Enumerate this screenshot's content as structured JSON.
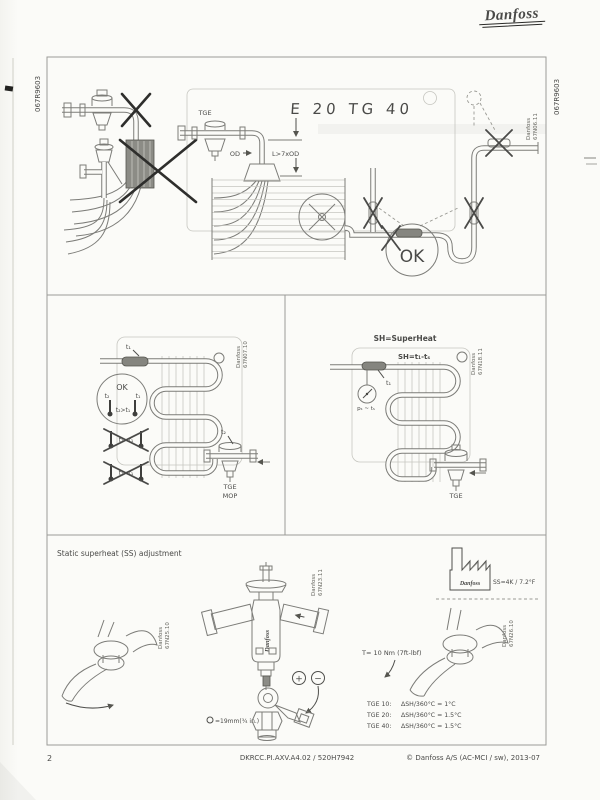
{
  "page": {
    "logo": "Danfoss",
    "code_left": "067R9603",
    "code_right": "067R9603",
    "footer": {
      "page": "2",
      "doc_id": "DKRCC.PI.AXV.A4.02 / 520H7942",
      "copyright": "© Danfoss A/S (AC-MCI / sw), 2013-07"
    },
    "colors": {
      "paper": "#fbfbf8",
      "line": "#7c7c78",
      "text": "#4a4a48"
    }
  },
  "panel_mounting": {
    "fig_brand": "Danfoss",
    "fig_no": "67N06.11",
    "valve_label": "TGE",
    "od_label": "OD",
    "length_label": "L>7xOD",
    "ok_label": "OK",
    "ghost_text": "E 20 TG 40"
  },
  "panel_bulb_check": {
    "fig_brand": "Danfoss",
    "fig_no": "67N07.10",
    "t1": "t₁",
    "t2": "t₂",
    "ok": "OK",
    "ok_t2": "t₂",
    "ok_t1": "t₁",
    "rule_ok": "t₂>t₁",
    "rule_wrong_equal": "t₂≈t₁",
    "rule_wrong_less": "t₂<t₁",
    "valve_line1": "TGE",
    "valve_line2": "MOP"
  },
  "panel_superheat": {
    "fig_brand": "Danfoss",
    "fig_no": "67N18.11",
    "title": "SH=SuperHeat",
    "formula": "SH=t₁-tₛ",
    "t1": "t₁",
    "gauge": "pₛ ~ tₛ",
    "valve_label": "TGE"
  },
  "panel_adjustment": {
    "title": "Static superheat (SS) adjustment",
    "factory_brand": "Danfoss",
    "factory_label": "SS=4K / 7.2°F",
    "fig_left_brand": "Danfoss",
    "fig_left_no": "67N25.10",
    "fig_center_brand": "Danfoss",
    "fig_center_no": "67N23.11",
    "fig_right_brand": "Danfoss",
    "fig_right_no": "67N26.10",
    "valve_brand": "Danfoss",
    "plus": "+",
    "minus": "−",
    "wrench_size": "=19mm(¾ in.)",
    "torque": "T= 10 Nm (7ft-lbf)",
    "table": {
      "rows": [
        {
          "model": "TGE 10:",
          "value": "ΔSH/360°C = 1°C"
        },
        {
          "model": "TGE 20:",
          "value": "ΔSH/360°C = 1.5°C"
        },
        {
          "model": "TGE 40:",
          "value": "ΔSH/360°C = 1.5°C"
        }
      ]
    }
  }
}
